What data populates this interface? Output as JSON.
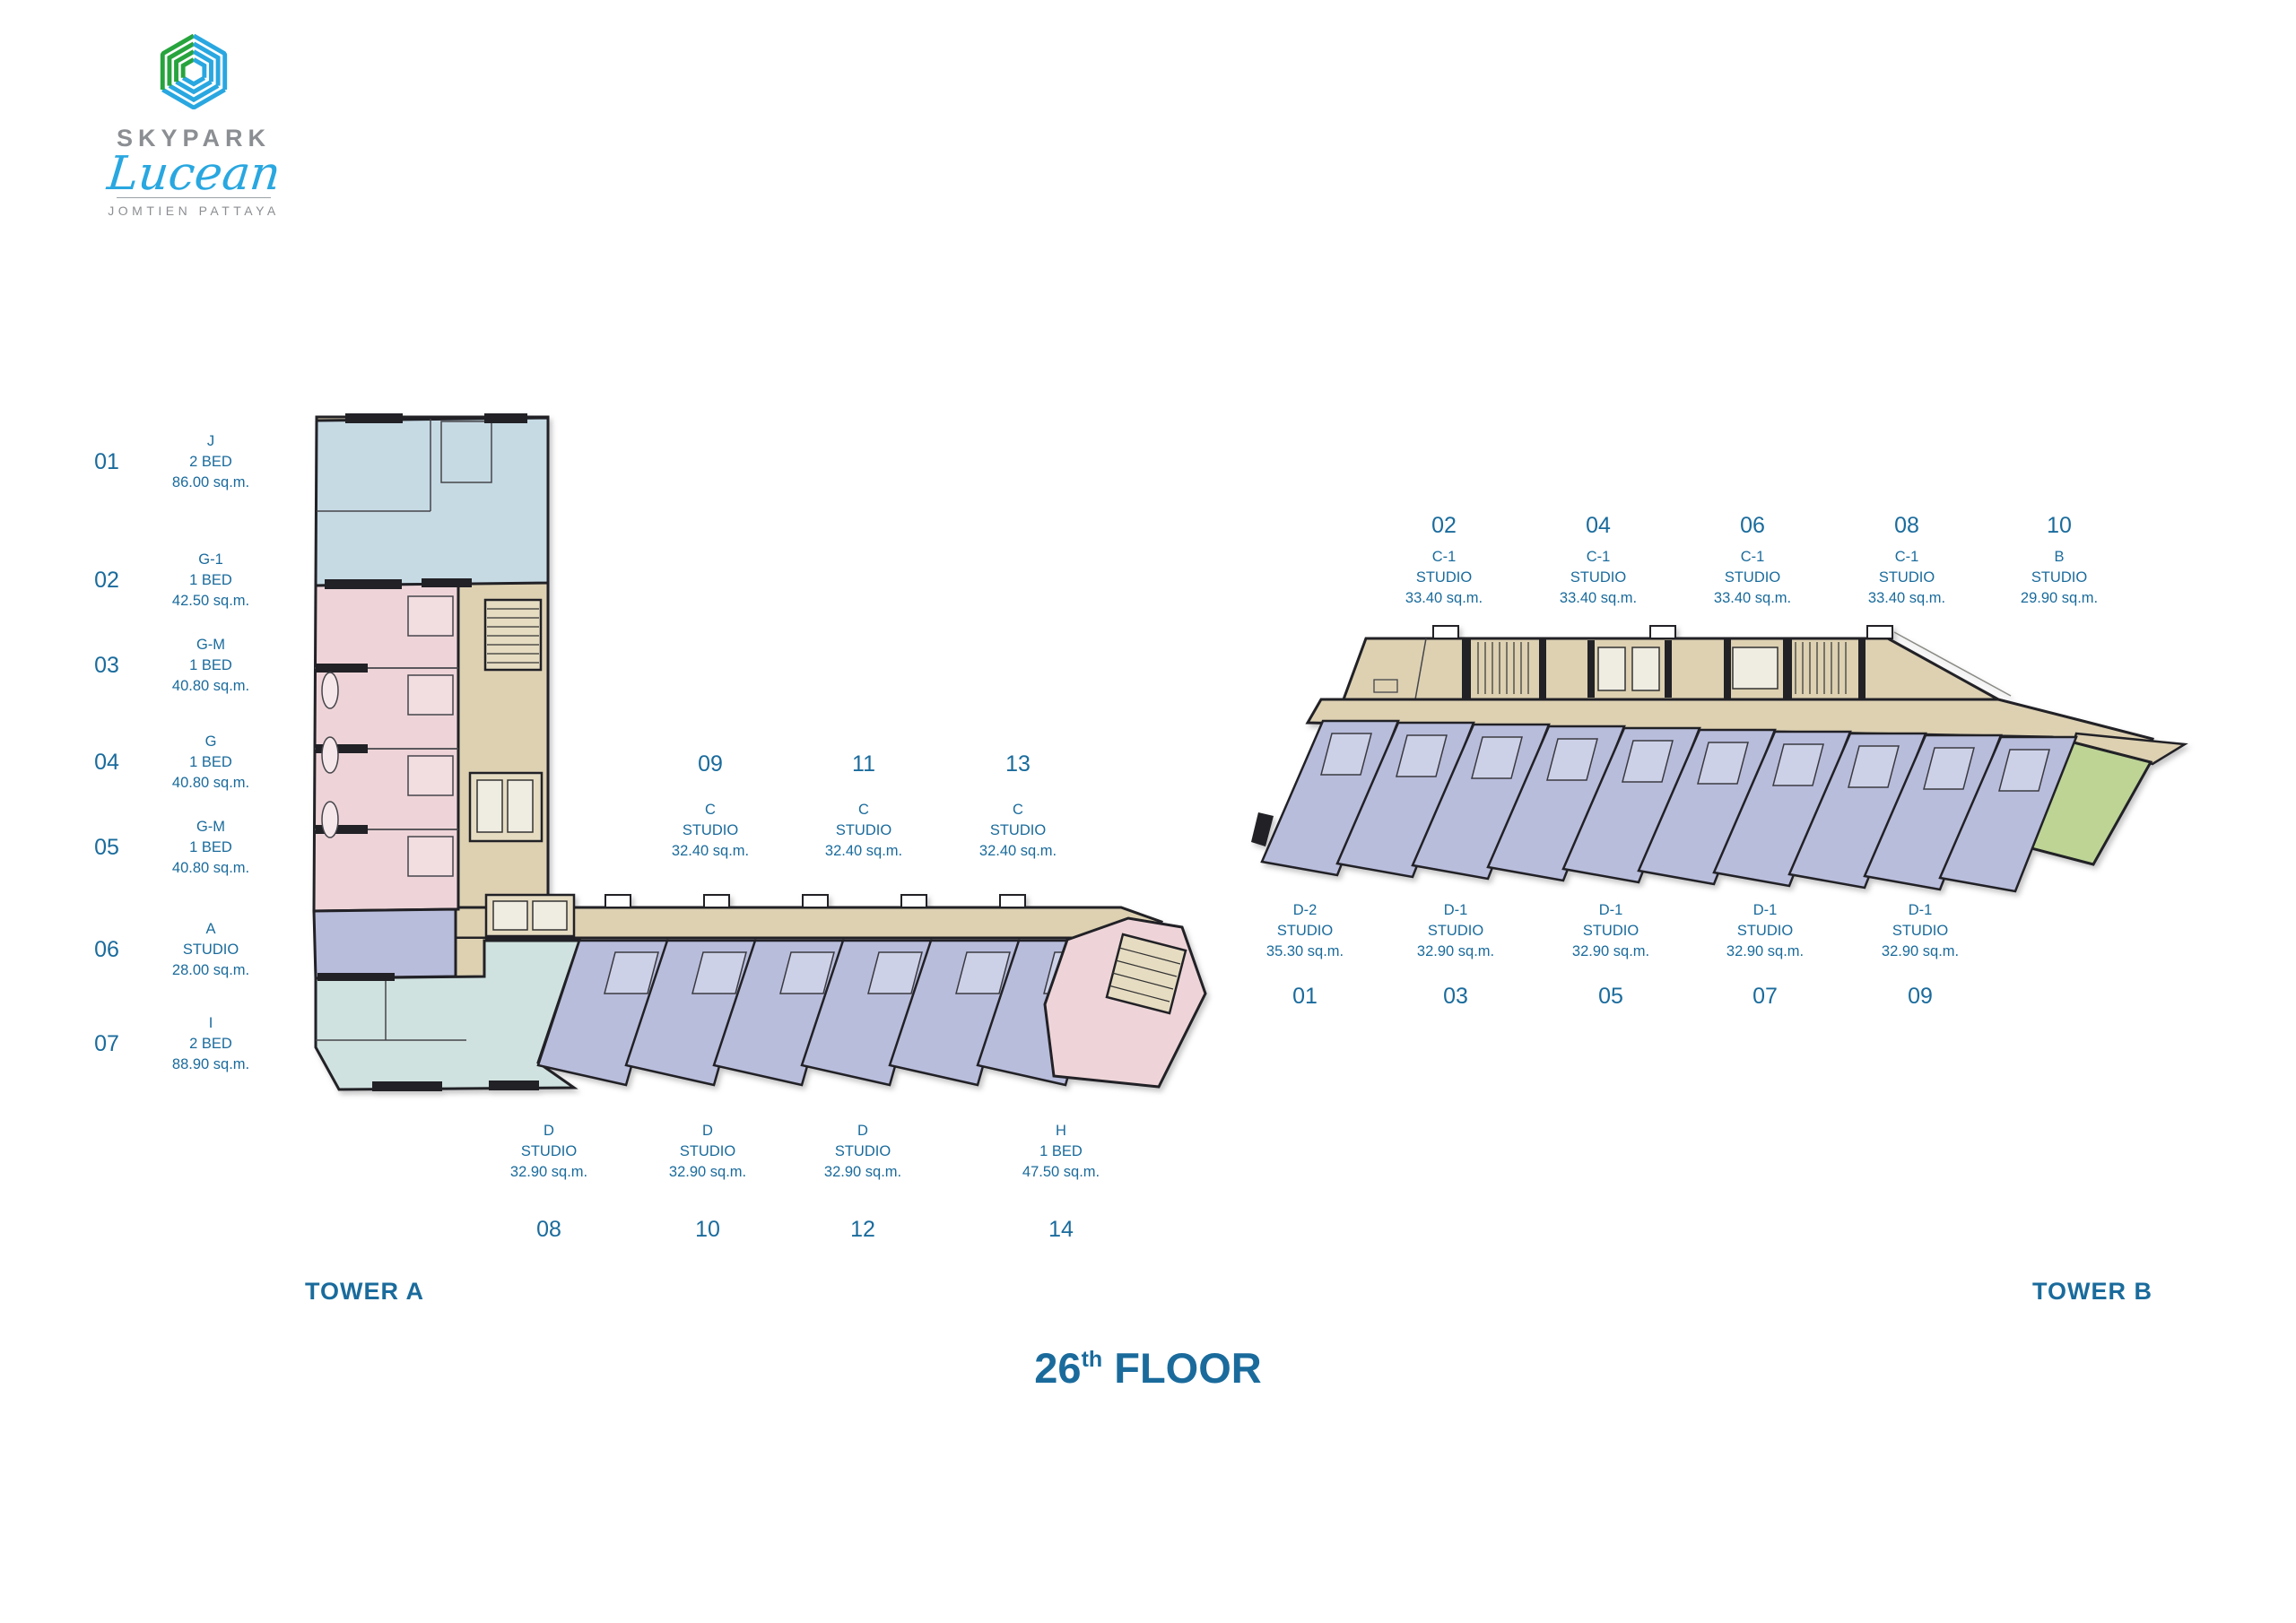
{
  "logo": {
    "brand": "SKYPARK",
    "name": "Lucean",
    "location": "JOMTIEN PATTAYA"
  },
  "floor_title": {
    "number": "26",
    "ordinal": "th",
    "word": "FLOOR"
  },
  "tower_a": {
    "label": "TOWER A",
    "legend": [
      {
        "no": "01",
        "type": "J",
        "layout": "2 BED",
        "area": "86.00 sq.m."
      },
      {
        "no": "02",
        "type": "G-1",
        "layout": "1 BED",
        "area": "42.50 sq.m."
      },
      {
        "no": "03",
        "type": "G-M",
        "layout": "1 BED",
        "area": "40.80 sq.m."
      },
      {
        "no": "04",
        "type": "G",
        "layout": "1 BED",
        "area": "40.80 sq.m."
      },
      {
        "no": "05",
        "type": "G-M",
        "layout": "1 BED",
        "area": "40.80 sq.m."
      },
      {
        "no": "06",
        "type": "A",
        "layout": "STUDIO",
        "area": "28.00 sq.m."
      },
      {
        "no": "07",
        "type": "I",
        "layout": "2 BED",
        "area": "88.90 sq.m."
      }
    ],
    "corridor_units": [
      {
        "no": "09",
        "type": "C",
        "layout": "STUDIO",
        "area": "32.40 sq.m."
      },
      {
        "no": "11",
        "type": "C",
        "layout": "STUDIO",
        "area": "32.40 sq.m."
      },
      {
        "no": "13",
        "type": "C",
        "layout": "STUDIO",
        "area": "32.40 sq.m."
      }
    ],
    "lower_units": [
      {
        "no": "08",
        "type": "D",
        "layout": "STUDIO",
        "area": "32.90 sq.m."
      },
      {
        "no": "10",
        "type": "D",
        "layout": "STUDIO",
        "area": "32.90 sq.m."
      },
      {
        "no": "12",
        "type": "D",
        "layout": "STUDIO",
        "area": "32.90 sq.m."
      },
      {
        "no": "14",
        "type": "H",
        "layout": "1 BED",
        "area": "47.50 sq.m."
      }
    ]
  },
  "tower_b": {
    "label": "TOWER B",
    "upper_units": [
      {
        "no": "02",
        "type": "C-1",
        "layout": "STUDIO",
        "area": "33.40 sq.m."
      },
      {
        "no": "04",
        "type": "C-1",
        "layout": "STUDIO",
        "area": "33.40 sq.m."
      },
      {
        "no": "06",
        "type": "C-1",
        "layout": "STUDIO",
        "area": "33.40 sq.m."
      },
      {
        "no": "08",
        "type": "C-1",
        "layout": "STUDIO",
        "area": "33.40 sq.m."
      },
      {
        "no": "10",
        "type": "B",
        "layout": "STUDIO",
        "area": "29.90 sq.m."
      }
    ],
    "lower_units": [
      {
        "no": "01",
        "type": "D-2",
        "layout": "STUDIO",
        "area": "35.30 sq.m."
      },
      {
        "no": "03",
        "type": "D-1",
        "layout": "STUDIO",
        "area": "32.90 sq.m."
      },
      {
        "no": "05",
        "type": "D-1",
        "layout": "STUDIO",
        "area": "32.90 sq.m."
      },
      {
        "no": "07",
        "type": "D-1",
        "layout": "STUDIO",
        "area": "32.90 sq.m."
      },
      {
        "no": "09",
        "type": "D-1",
        "layout": "STUDIO",
        "area": "32.90 sq.m."
      }
    ]
  },
  "colors": {
    "label_blue": "#1a6b9c",
    "logo_blue": "#29a7e0",
    "logo_green": "#27a43d",
    "logo_gray": "#8b8e92",
    "corridor_tan": "#ddd1b2",
    "unit_pink": "#eed4d8",
    "unit_lavender": "#b9bddc",
    "unit_lightblue": "#c6dae4",
    "unit_teal": "#d0e2df",
    "unit_green": "#bdd495",
    "wall": "#212126"
  }
}
